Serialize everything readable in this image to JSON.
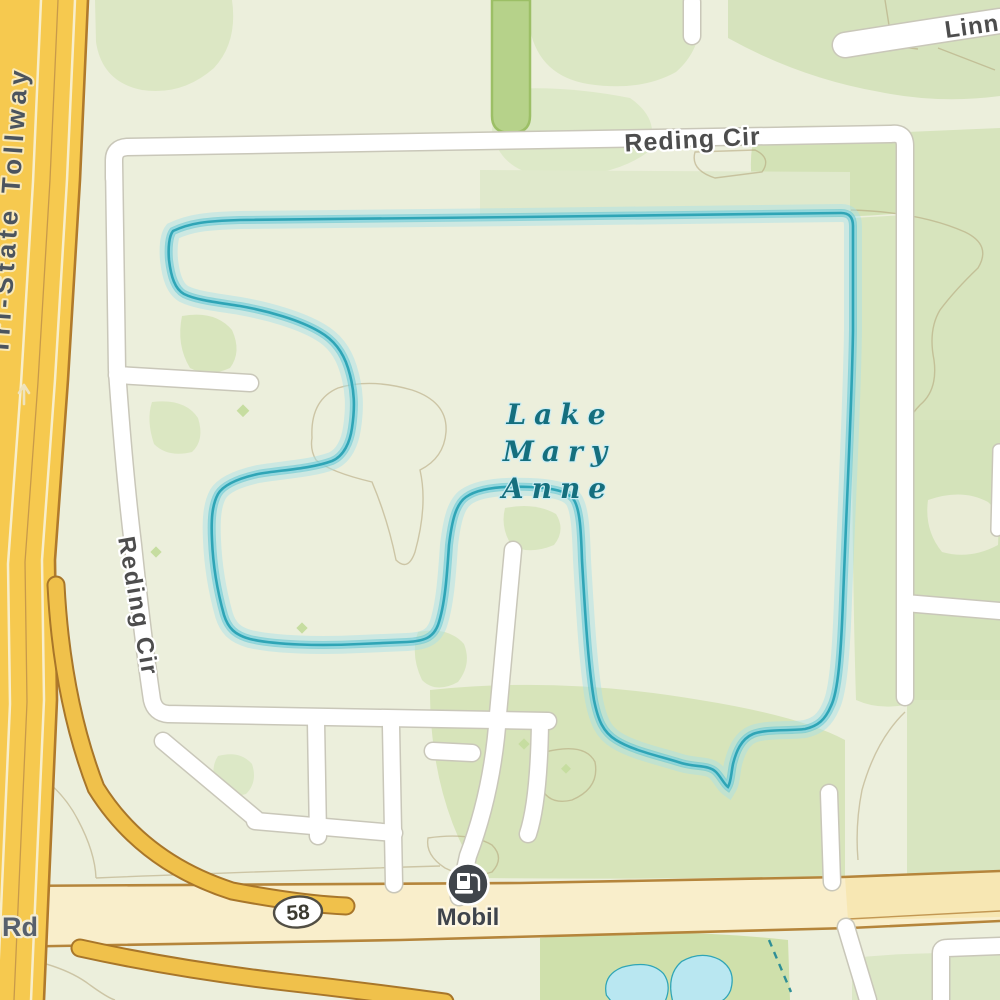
{
  "labels": {
    "tollway": "Tri-State Tollway",
    "reding_cir_top": "Reding Cir",
    "reding_cir_west": "Reding Cir",
    "linneman": "Linneman",
    "road_rd": "Rd",
    "route_shield": "58",
    "gas_station": "Mobil"
  },
  "lake": {
    "line1": "Lake",
    "line2": "Mary",
    "line3": "Anne"
  },
  "icons": {
    "gas_station": "fuel-pump",
    "one_way_arrow": "up-arrow"
  },
  "colors": {
    "land_base": "#ecefdc",
    "veg_green": "#d6e4ba",
    "veg_green_dark": "#cfe0ab",
    "water_fill": "#bde9f1",
    "water_edge": "#2fa5b6",
    "water_glow": "#a7dfe9",
    "water_label": "#156f7e",
    "road_white": "#ffffff",
    "road_casing": "#c9c7b9",
    "highway_fill": "#f9eecb",
    "highway_casing": "#b5853b",
    "tollway_fill": "#f6c94f",
    "tollway_casing": "#b07a2c",
    "ramp_fill": "#f0c14b",
    "park_strip": "#b6d28a",
    "park_strip_edge": "#9cbf66",
    "contour": "#b3a379",
    "label_dark": "#4d4d4d",
    "poi_dark": "#3f444b"
  }
}
